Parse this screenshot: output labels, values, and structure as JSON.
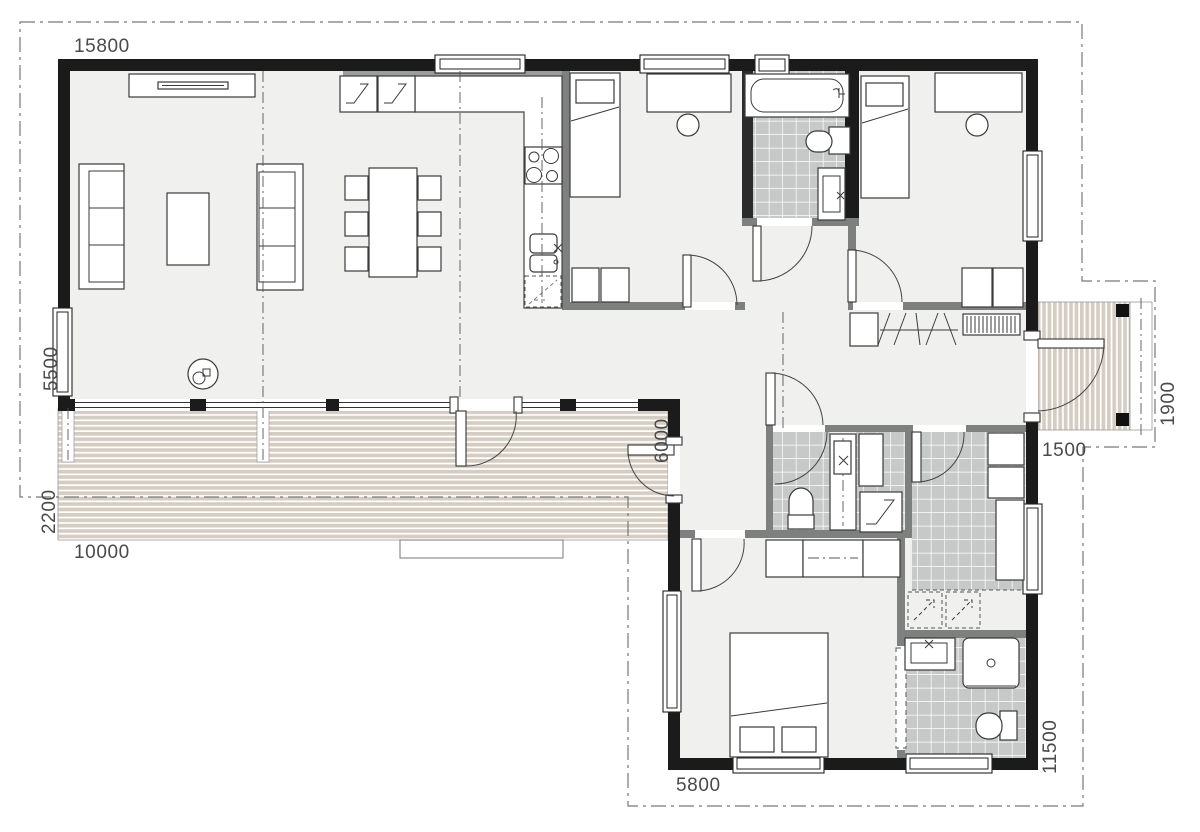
{
  "drawing": {
    "type": "architectural-floor-plan",
    "dims": {
      "top_width": "15800",
      "left_height": "5500",
      "terrace_depth": "2200",
      "terrace_width": "10000",
      "inner_width": "6000",
      "porch_depth": "1500",
      "porch_width": "1900",
      "right_height": "11500",
      "wing_width": "5800"
    },
    "colors": {
      "wall": "#1b1b1b",
      "interior_wall": "#7d807e",
      "floor": "#f0f1ef",
      "tile": "#c6c9c7",
      "deck": "#d6cdc2",
      "boundary": "#777777",
      "text": "#4a4a4a"
    }
  }
}
